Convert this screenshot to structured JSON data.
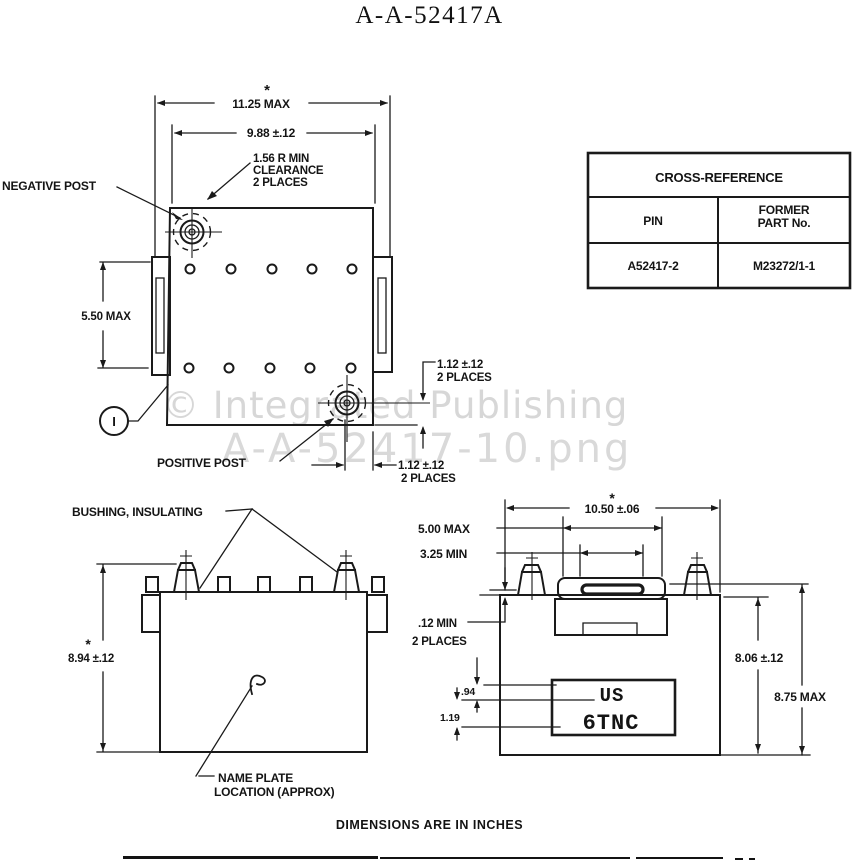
{
  "title": "A-A-52417A",
  "watermark": {
    "line1": "© Integrated Publishing",
    "line2": "A-A-52417-10.png"
  },
  "footer_note": "DIMENSIONS ARE IN INCHES",
  "colors": {
    "ink": "#1a1a1a",
    "watermark": "#d7d7d7",
    "paper": "#ffffff"
  },
  "top_view": {
    "dim_width_max": "11.25 MAX",
    "dim_width_tol": "9.88 ±.12",
    "asterisk": "*",
    "clearance_l1": "1.56 R MIN",
    "clearance_l2": "CLEARANCE",
    "clearance_l3": "2 PLACES",
    "negative_post": "NEGATIVE POST",
    "positive_post": "POSITIVE POST",
    "dim_height_max": "5.50 MAX",
    "dim_post_right_l1": "1.12 ±.12",
    "dim_post_right_l2": "2 PLACES",
    "dim_post_bottom_l1": "1.12 ±.12",
    "dim_post_bottom_l2": "2 PLACES",
    "balloon": "I"
  },
  "cross_reference": {
    "title": "CROSS-REFERENCE",
    "col_pin": "PIN",
    "col_former_l1": "FORMER",
    "col_former_l2": "PART No.",
    "pin_value": "A52417-2",
    "former_value": "M23272/1-1"
  },
  "front_view": {
    "bushing_label": "BUSHING, INSULATING",
    "asterisk": "*",
    "dim_height": "8.94 ±.12",
    "nameplate_l1": "NAME PLATE",
    "nameplate_l2": "LOCATION (APPROX)"
  },
  "side_view": {
    "asterisk": "*",
    "dim_width": "10.50 ±.06",
    "dim_handle_max": "5.00 MAX",
    "dim_handle_min": "3.25 MIN",
    "dim_gap_l1": ".12 MIN",
    "dim_gap_l2": "2 PLACES",
    "dim_plate_top": ".94",
    "dim_plate_bottom": "1.19",
    "dim_height_tol": "8.06 ±.12",
    "dim_height_max": "8.75 MAX",
    "plate_l1": "US",
    "plate_l2": "6TNC"
  }
}
